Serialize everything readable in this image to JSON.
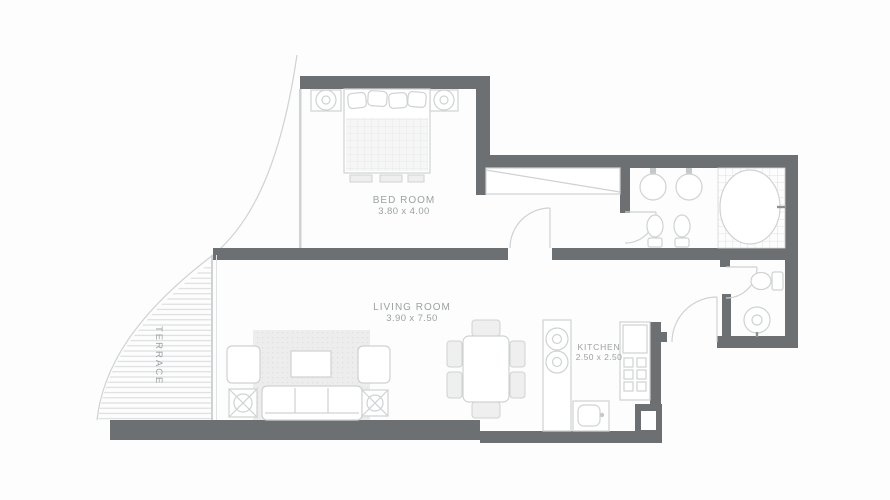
{
  "plan": {
    "rooms": [
      {
        "id": "bedroom",
        "name": "BED ROOM",
        "dimensions": "3.80 x 4.00"
      },
      {
        "id": "living",
        "name": "LIVING ROOM",
        "dimensions": "3.90 x 7.50"
      },
      {
        "id": "kitchen",
        "name": "KITCHEN",
        "dimensions": "2.50 x 2.50"
      },
      {
        "id": "terrace",
        "name": "TERRACE",
        "dimensions": ""
      }
    ],
    "colors": {
      "wall": "#6d7072",
      "line": "#cfd2d3",
      "line_soft": "#e0e2e3",
      "fill_soft": "#efefef",
      "label": "#9ca1a2",
      "hatch": "#d9dbdc",
      "background": "#fdfdfd",
      "fixture_dark": "#8d9193"
    }
  }
}
